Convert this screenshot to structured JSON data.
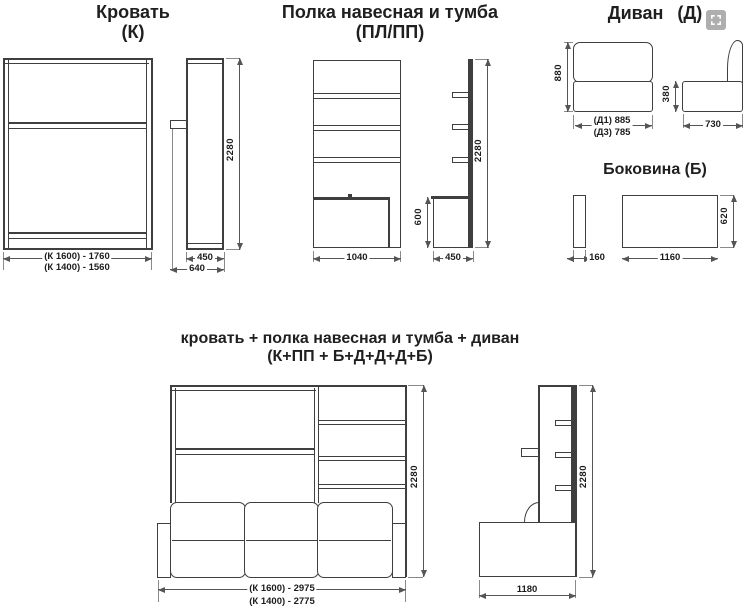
{
  "page": {
    "background": "#ffffff",
    "line_color": "#3f3f3f",
    "text_color": "#1c1c1c"
  },
  "controls": {
    "expand_icon": "expand-icon"
  },
  "bed": {
    "title": "Кровать",
    "code": "(К)",
    "front": {
      "width_k1600": "(К 1600) - 1760",
      "width_k1400": "(К 1400) - 1560"
    },
    "side": {
      "height": "2280",
      "depth_body": "450",
      "depth_total": "640"
    }
  },
  "shelf": {
    "title": "Полка навесная и тумба",
    "code": "(ПЛ/ПП)",
    "front": {
      "width": "1040"
    },
    "side": {
      "cabinet_height": "600",
      "height": "2280",
      "depth": "450"
    }
  },
  "sofa": {
    "title": "Диван",
    "code": "(Д)",
    "front": {
      "height": "880",
      "width_d1": "(Д1) 885",
      "width_d3": "(Д3) 785"
    },
    "side": {
      "seat_height": "380",
      "depth": "730"
    }
  },
  "side_panel": {
    "title": "Боковина (Б)",
    "side": {
      "thickness": "160"
    },
    "front": {
      "width": "1160",
      "height": "620"
    }
  },
  "combo": {
    "title": "кровать + полка навесная и тумба + диван",
    "code": "(К+ПП + Б+Д+Д+Д+Б)",
    "front": {
      "height": "2280",
      "width_k1600": "(К 1600) - 2975",
      "width_k1400": "(К 1400) - 2775"
    },
    "side": {
      "height": "2280",
      "depth": "1180"
    }
  }
}
